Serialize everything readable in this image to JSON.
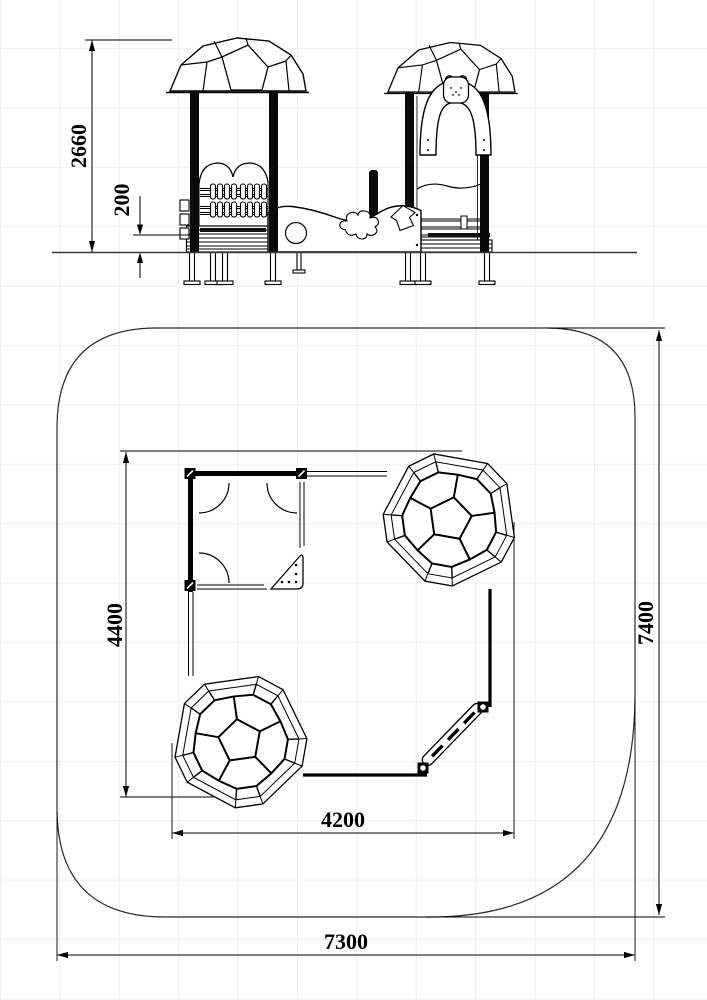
{
  "colors": {
    "line": "#000000",
    "ground": "#3a3a3a",
    "boundary": "#2a2a2a",
    "grid": "#efefef",
    "background": "#ffffff"
  },
  "views": {
    "front_elevation": {
      "dimensions": {
        "overall_height": {
          "value": "2660"
        },
        "platform_height": {
          "value": "200"
        }
      },
      "components": [
        "canopy-roof-left",
        "canopy-roof-right",
        "abacus-bead-panel",
        "wavy-balustrade-panel",
        "toddler-arch-with-bear",
        "climbing-rungs",
        "support-posts",
        "ground-anchors"
      ]
    },
    "top_plan": {
      "dimensions": {
        "equipment_depth": {
          "value": "4400"
        },
        "safety_area_depth": {
          "value": "7400"
        },
        "equipment_width": {
          "value": "4200"
        },
        "safety_area_width": {
          "value": "7300"
        }
      },
      "components": [
        "safety-area-boundary",
        "playhouse-footprint",
        "geodesic-dome-top-right",
        "geodesic-dome-bottom-left",
        "balance-beam",
        "corner-seat",
        "door-swing-arcs"
      ]
    }
  }
}
